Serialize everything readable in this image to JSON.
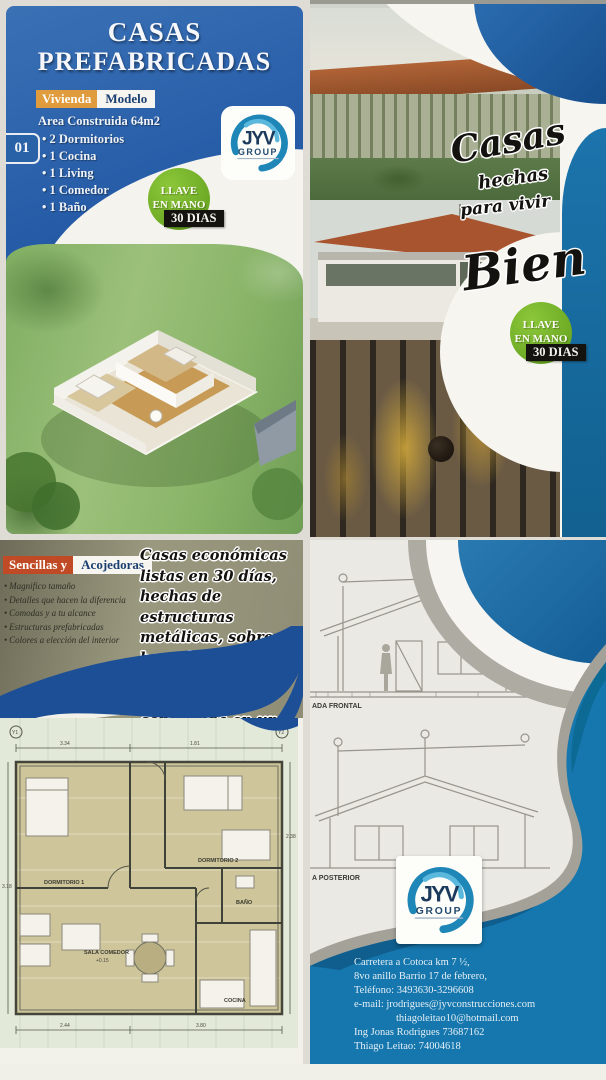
{
  "colors": {
    "panel_blue": "#2257a4",
    "accent_blue": "#1577ad",
    "green_badge": "#72b32a",
    "orange": "#e09b3d",
    "red_orange": "#c14a26"
  },
  "logo": {
    "jyv": "JYV",
    "group": "GROUP"
  },
  "badge": {
    "line1": "LLAVE",
    "line2": "EN MANO",
    "days": "30 DIAS"
  },
  "panel_tl": {
    "title_line1": "CASAS",
    "title_line2": "PREFABRICADAS",
    "unit_number": "01",
    "tag_vivienda": "Vivienda",
    "tag_modelo": "Modelo",
    "area_line": "Area Construida 64m2",
    "features": [
      "2 Dormitorios",
      "1 Cocina",
      "1 Living",
      "1 Comedor",
      "1 Baño"
    ]
  },
  "panel_tr": {
    "script_line1": "Casas",
    "script_line2": "hechas",
    "script_line3": "para vivir",
    "script_line4": "Bien"
  },
  "panel_bl": {
    "tag_sencillas": "Sencillas y",
    "tag_acojedoras": "Acojedoras",
    "features": [
      "Magnifico tamaño",
      "Detalles que hacen la diferencia",
      "Comodas y a tu alcance",
      "Estructuras prefabricadas",
      "Colores a elección del interior"
    ],
    "script_text": "Casas económicas listas en 30 días, hechas de estructuras metálicas, sobre base de hormigón, con materiales de prime ra, construida en una área de 64 m2.",
    "plan": {
      "rooms": {
        "dorm1": "DORMITORIO 1",
        "dorm2": "DORMITORIO 2",
        "sala": "SALA COMEDOR",
        "cocina": "COCINA",
        "bano": "BAÑO"
      },
      "dims": {
        "top1": "3.34",
        "top2": "1.81",
        "right1": "2.38",
        "bottom1": "2.44",
        "bottom2": "3.80",
        "left1": "3.18",
        "level": "+0.15"
      },
      "axis1": "Y1",
      "axis2": "Y2"
    }
  },
  "panel_br": {
    "label_frontal": "ADA FRONTAL",
    "label_posterior": "A POSTERIOR",
    "contact": [
      "Carretera a Cotoca km 7 ½,",
      "8vo anillo Barrio 17 de febrero,",
      "Teléfono: 3493630-3296608",
      "e-mail: jrodrigues@jyvconstrucciones.com",
      "thiagoleitao10@hotmail.com",
      "Ing Jonas Rodrigues 73687162",
      "Thiago Leitao: 74004618"
    ]
  }
}
